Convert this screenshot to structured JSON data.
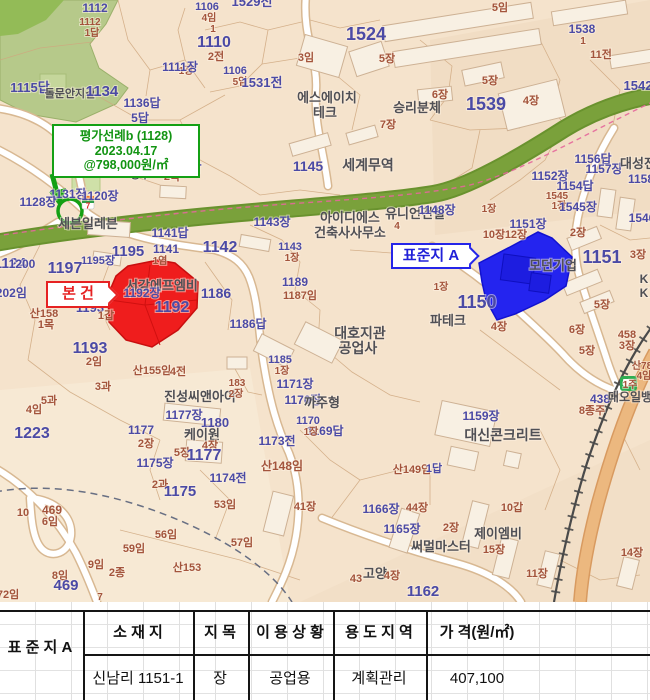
{
  "colors": {
    "parcel_text": "#4b4aa5",
    "suffix_text": "#a3543c",
    "poi_text": "#4f4f55",
    "note_green": "#14a014",
    "subject_red": "#e62222",
    "standard_blue": "#2525e8",
    "map_bg": "#f5e3cc",
    "forest": "#b6c98a",
    "greenway": "#7aa13b",
    "subject_parcel_fill": "#ef1d1d",
    "standard_parcel_fill": "#2424ef"
  },
  "map": {
    "green_note": {
      "line1": "평가선례b (1128)",
      "line2": "2023.04.17",
      "line3": "@798,000원/㎡"
    },
    "subject_label": "본 건",
    "standard_label": "표준지 A",
    "labels": [
      {
        "t": "1115답",
        "x": 30,
        "y": 92,
        "c": "p",
        "s": 13
      },
      {
        "t": "5답",
        "x": 140,
        "y": 122,
        "c": "p",
        "s": 12
      },
      {
        "t": "1116",
        "x": 162,
        "y": 163,
        "c": "p",
        "s": 19
      },
      {
        "t": "2목",
        "x": 172,
        "y": 180,
        "c": "m",
        "s": 11
      },
      {
        "t": "1124",
        "x": 10,
        "y": 268,
        "c": "p",
        "s": 15
      },
      {
        "t": "돌문안지길",
        "x": 70,
        "y": 97,
        "c": "g",
        "s": 11
      },
      {
        "t": "1134",
        "x": 102,
        "y": 96,
        "c": "p",
        "s": 15
      },
      {
        "t": "1112",
        "x": 95,
        "y": 12,
        "c": "p",
        "s": 12
      },
      {
        "t": "1112",
        "x": 90,
        "y": 25,
        "c": "m",
        "s": 10
      },
      {
        "t": "1답",
        "x": 92,
        "y": 36,
        "c": "m",
        "s": 10
      },
      {
        "t": "1136답",
        "x": 142,
        "y": 107,
        "c": "p",
        "s": 12
      },
      {
        "t": "1106",
        "x": 207,
        "y": 10,
        "c": "p",
        "s": 11
      },
      {
        "t": "4임",
        "x": 209,
        "y": 21,
        "c": "m",
        "s": 10
      },
      {
        "t": "1",
        "x": 213,
        "y": 32,
        "c": "m",
        "s": 10
      },
      {
        "t": "1529전",
        "x": 252,
        "y": 6,
        "c": "p",
        "s": 13
      },
      {
        "t": "1110",
        "x": 214,
        "y": 47,
        "c": "p",
        "s": 16
      },
      {
        "t": "2전",
        "x": 216,
        "y": 60,
        "c": "m",
        "s": 11
      },
      {
        "t": "1장",
        "x": 186,
        "y": 74,
        "c": "m",
        "s": 10
      },
      {
        "t": "1111장",
        "x": 180,
        "y": 71,
        "c": "p",
        "s": 12
      },
      {
        "t": "1106",
        "x": 235,
        "y": 74,
        "c": "p",
        "s": 11
      },
      {
        "t": "5임",
        "x": 240,
        "y": 85,
        "c": "m",
        "s": 10
      },
      {
        "t": "1531전",
        "x": 262,
        "y": 87,
        "c": "p",
        "s": 13
      },
      {
        "t": "3임",
        "x": 306,
        "y": 61,
        "c": "m",
        "s": 11
      },
      {
        "t": "1524",
        "x": 366,
        "y": 40,
        "c": "p",
        "s": 18
      },
      {
        "t": "5장",
        "x": 387,
        "y": 62,
        "c": "m",
        "s": 11
      },
      {
        "t": "에스에이치",
        "x": 327,
        "y": 102,
        "c": "g",
        "s": 13
      },
      {
        "t": "테크",
        "x": 325,
        "y": 117,
        "c": "g",
        "s": 13
      },
      {
        "t": "승리분체",
        "x": 417,
        "y": 112,
        "c": "g",
        "s": 13
      },
      {
        "t": "7장",
        "x": 388,
        "y": 128,
        "c": "m",
        "s": 11
      },
      {
        "t": "5임",
        "x": 500,
        "y": 11,
        "c": "m",
        "s": 11
      },
      {
        "t": "1538",
        "x": 582,
        "y": 33,
        "c": "p",
        "s": 12
      },
      {
        "t": "1",
        "x": 583,
        "y": 44,
        "c": "m",
        "s": 10
      },
      {
        "t": "11전",
        "x": 601,
        "y": 58,
        "c": "m",
        "s": 11
      },
      {
        "t": "5장",
        "x": 490,
        "y": 84,
        "c": "m",
        "s": 11
      },
      {
        "t": "6장",
        "x": 440,
        "y": 98,
        "c": "m",
        "s": 11
      },
      {
        "t": "1539",
        "x": 486,
        "y": 110,
        "c": "p",
        "s": 18
      },
      {
        "t": "4장",
        "x": 531,
        "y": 104,
        "c": "m",
        "s": 11
      },
      {
        "t": "1542",
        "x": 638,
        "y": 90,
        "c": "p",
        "s": 13
      },
      {
        "t": "1156답",
        "x": 593,
        "y": 163,
        "c": "p",
        "s": 12
      },
      {
        "t": "1157장",
        "x": 604,
        "y": 173,
        "c": "p",
        "s": 12
      },
      {
        "t": "대성전",
        "x": 638,
        "y": 168,
        "c": "g",
        "s": 13
      },
      {
        "t": "1152장",
        "x": 550,
        "y": 180,
        "c": "p",
        "s": 12
      },
      {
        "t": "1154답",
        "x": 575,
        "y": 190,
        "c": "p",
        "s": 12
      },
      {
        "t": "1545",
        "x": 557,
        "y": 199,
        "c": "m",
        "s": 10
      },
      {
        "t": "1장",
        "x": 559,
        "y": 209,
        "c": "m",
        "s": 10
      },
      {
        "t": "1545장",
        "x": 578,
        "y": 211,
        "c": "p",
        "s": 12
      },
      {
        "t": "1158",
        "x": 641,
        "y": 183,
        "c": "p",
        "s": 12
      },
      {
        "t": "1546",
        "x": 642,
        "y": 222,
        "c": "p",
        "s": 12
      },
      {
        "t": "1151장",
        "x": 528,
        "y": 228,
        "c": "p",
        "s": 12
      },
      {
        "t": "2장",
        "x": 578,
        "y": 236,
        "c": "m",
        "s": 11
      },
      {
        "t": "3장",
        "x": 638,
        "y": 258,
        "c": "m",
        "s": 11
      },
      {
        "t": "유니언건설",
        "x": 415,
        "y": 218,
        "c": "g",
        "s": 13
      },
      {
        "t": "1148장",
        "x": 437,
        "y": 214,
        "c": "p",
        "s": 12
      },
      {
        "t": "4",
        "x": 397,
        "y": 229,
        "c": "m",
        "s": 10
      },
      {
        "t": "1장",
        "x": 489,
        "y": 212,
        "c": "m",
        "s": 10
      },
      {
        "t": "10장",
        "x": 494,
        "y": 238,
        "c": "m",
        "s": 11
      },
      {
        "t": "12장",
        "x": 516,
        "y": 238,
        "c": "m",
        "s": 11
      },
      {
        "t": "1151",
        "x": 602,
        "y": 263,
        "c": "p",
        "s": 18
      },
      {
        "t": "모던기업",
        "x": 553,
        "y": 270,
        "c": "g",
        "s": 13
      },
      {
        "t": "K",
        "x": 644,
        "y": 283,
        "c": "g",
        "s": 12
      },
      {
        "t": "K",
        "x": 644,
        "y": 297,
        "c": "g",
        "s": 12
      },
      {
        "t": "1150",
        "x": 477,
        "y": 308,
        "c": "p",
        "s": 18
      },
      {
        "t": "파테크",
        "x": 448,
        "y": 325,
        "c": "g",
        "s": 13
      },
      {
        "t": "4장",
        "x": 499,
        "y": 330,
        "c": "m",
        "s": 11
      },
      {
        "t": "1장",
        "x": 441,
        "y": 290,
        "c": "m",
        "s": 10
      },
      {
        "t": "5장",
        "x": 602,
        "y": 308,
        "c": "m",
        "s": 11
      },
      {
        "t": "6장",
        "x": 577,
        "y": 333,
        "c": "m",
        "s": 11
      },
      {
        "t": "5장",
        "x": 587,
        "y": 354,
        "c": "m",
        "s": 11
      },
      {
        "t": "458",
        "x": 627,
        "y": 338,
        "c": "m",
        "s": 11
      },
      {
        "t": "3장",
        "x": 627,
        "y": 349,
        "c": "m",
        "s": 11
      },
      {
        "t": "산78",
        "x": 642,
        "y": 369,
        "c": "m",
        "s": 10
      },
      {
        "t": "4임",
        "x": 644,
        "y": 379,
        "c": "m",
        "s": 10
      },
      {
        "t": "1주",
        "x": 630,
        "y": 388,
        "c": "m",
        "s": 10
      },
      {
        "t": "1145",
        "x": 308,
        "y": 171,
        "c": "p",
        "s": 14
      },
      {
        "t": "세계무역",
        "x": 368,
        "y": 170,
        "c": "g",
        "s": 14
      },
      {
        "t": "아이디에스",
        "x": 350,
        "y": 222,
        "c": "g",
        "s": 13
      },
      {
        "t": "건축사사무소",
        "x": 350,
        "y": 237,
        "c": "g",
        "s": 13
      },
      {
        "t": "1143장",
        "x": 272,
        "y": 226,
        "c": "p",
        "s": 12
      },
      {
        "t": "1142",
        "x": 220,
        "y": 252,
        "c": "p",
        "s": 16
      },
      {
        "t": "1143",
        "x": 290,
        "y": 250,
        "c": "p",
        "s": 11
      },
      {
        "t": "1장",
        "x": 292,
        "y": 261,
        "c": "m",
        "s": 10
      },
      {
        "t": "1140답",
        "x": 183,
        "y": 172,
        "c": "p",
        "s": 12
      },
      {
        "t": "싱루",
        "x": 140,
        "y": 178,
        "c": "g",
        "s": 11
      },
      {
        "t": "1131장",
        "x": 68,
        "y": 198,
        "c": "p",
        "s": 12
      },
      {
        "t": "1120장",
        "x": 100,
        "y": 200,
        "c": "p",
        "s": 12
      },
      {
        "t": "1128장",
        "x": 38,
        "y": 206,
        "c": "p",
        "s": 12
      },
      {
        "t": "세븐일레븐",
        "x": 88,
        "y": 228,
        "c": "g",
        "s": 13
      },
      {
        "t": "1141답",
        "x": 170,
        "y": 237,
        "c": "p",
        "s": 12
      },
      {
        "t": "1141",
        "x": 166,
        "y": 253,
        "c": "p",
        "s": 12
      },
      {
        "t": "1염",
        "x": 160,
        "y": 264,
        "c": "m",
        "s": 10
      },
      {
        "t": "1195",
        "x": 128,
        "y": 256,
        "c": "p",
        "s": 15
      },
      {
        "t": "1195장",
        "x": 98,
        "y": 264,
        "c": "p",
        "s": 11
      },
      {
        "t": "1197",
        "x": 65,
        "y": 273,
        "c": "p",
        "s": 16
      },
      {
        "t": "1200",
        "x": 22,
        "y": 268,
        "c": "p",
        "s": 12
      },
      {
        "t": "1202임",
        "x": 8,
        "y": 297,
        "c": "p",
        "s": 12
      },
      {
        "t": "산158",
        "x": 44,
        "y": 317,
        "c": "m",
        "s": 11
      },
      {
        "t": "1목",
        "x": 46,
        "y": 328,
        "c": "m",
        "s": 11
      },
      {
        "t": "서강에프엠비",
        "x": 162,
        "y": 290,
        "c": "g",
        "s": 13
      },
      {
        "t": "1192장",
        "x": 142,
        "y": 297,
        "c": "p",
        "s": 12
      },
      {
        "t": "1192",
        "x": 172,
        "y": 312,
        "c": "p",
        "s": 16
      },
      {
        "t": "1186",
        "x": 216,
        "y": 298,
        "c": "p",
        "s": 14
      },
      {
        "t": "1189",
        "x": 295,
        "y": 286,
        "c": "p",
        "s": 12
      },
      {
        "t": "1187임",
        "x": 300,
        "y": 299,
        "c": "m",
        "s": 11
      },
      {
        "t": "1186답",
        "x": 248,
        "y": 328,
        "c": "p",
        "s": 12
      },
      {
        "t": "1193",
        "x": 90,
        "y": 312,
        "c": "p",
        "s": 13
      },
      {
        "t": "1갑",
        "x": 106,
        "y": 319,
        "c": "m",
        "s": 11
      },
      {
        "t": "1193",
        "x": 90,
        "y": 353,
        "c": "p",
        "s": 16
      },
      {
        "t": "2임",
        "x": 94,
        "y": 365,
        "c": "m",
        "s": 11
      },
      {
        "t": "1223",
        "x": 32,
        "y": 438,
        "c": "p",
        "s": 16
      },
      {
        "t": "산155임",
        "x": 152,
        "y": 374,
        "c": "m",
        "s": 11
      },
      {
        "t": "4전",
        "x": 178,
        "y": 375,
        "c": "m",
        "s": 11
      },
      {
        "t": "3과",
        "x": 103,
        "y": 390,
        "c": "m",
        "s": 11
      },
      {
        "t": "5과",
        "x": 49,
        "y": 404,
        "c": "m",
        "s": 11
      },
      {
        "t": "4임",
        "x": 34,
        "y": 413,
        "c": "m",
        "s": 11
      },
      {
        "t": "진성씨앤아이",
        "x": 200,
        "y": 401,
        "c": "g",
        "s": 13
      },
      {
        "t": "1177장",
        "x": 184,
        "y": 419,
        "c": "p",
        "s": 12
      },
      {
        "t": "1180",
        "x": 215,
        "y": 427,
        "c": "p",
        "s": 13
      },
      {
        "t": "케이원",
        "x": 202,
        "y": 439,
        "c": "g",
        "s": 13
      },
      {
        "t": "4장",
        "x": 210,
        "y": 449,
        "c": "m",
        "s": 11
      },
      {
        "t": "1177",
        "x": 141,
        "y": 434,
        "c": "p",
        "s": 12
      },
      {
        "t": "2장",
        "x": 146,
        "y": 447,
        "c": "m",
        "s": 11
      },
      {
        "t": "5장",
        "x": 182,
        "y": 456,
        "c": "m",
        "s": 11
      },
      {
        "t": "1177",
        "x": 204,
        "y": 460,
        "c": "p",
        "s": 16
      },
      {
        "t": "1175장",
        "x": 155,
        "y": 467,
        "c": "p",
        "s": 12
      },
      {
        "t": "2과",
        "x": 160,
        "y": 488,
        "c": "m",
        "s": 11
      },
      {
        "t": "1175",
        "x": 180,
        "y": 496,
        "c": "p",
        "s": 15
      },
      {
        "t": "1174전",
        "x": 228,
        "y": 482,
        "c": "p",
        "s": 12
      },
      {
        "t": "53임",
        "x": 225,
        "y": 508,
        "c": "m",
        "s": 11
      },
      {
        "t": "산148임",
        "x": 282,
        "y": 470,
        "c": "m",
        "s": 12
      },
      {
        "t": "1173전",
        "x": 277,
        "y": 445,
        "c": "p",
        "s": 12
      },
      {
        "t": "1169답",
        "x": 325,
        "y": 435,
        "c": "p",
        "s": 12
      },
      {
        "t": "1170",
        "x": 308,
        "y": 424,
        "c": "p",
        "s": 11
      },
      {
        "t": "1장",
        "x": 311,
        "y": 435,
        "c": "m",
        "s": 10
      },
      {
        "t": "1171장",
        "x": 295,
        "y": 388,
        "c": "p",
        "s": 12
      },
      {
        "t": "1170장",
        "x": 303,
        "y": 404,
        "c": "p",
        "s": 12
      },
      {
        "t": "까주형",
        "x": 322,
        "y": 407,
        "c": "g",
        "s": 13
      },
      {
        "t": "1185",
        "x": 280,
        "y": 363,
        "c": "p",
        "s": 11
      },
      {
        "t": "1장",
        "x": 282,
        "y": 374,
        "c": "m",
        "s": 10
      },
      {
        "t": "183",
        "x": 237,
        "y": 386,
        "c": "m",
        "s": 10
      },
      {
        "t": "2장",
        "x": 236,
        "y": 397,
        "c": "m",
        "s": 10
      },
      {
        "t": "대호지관",
        "x": 360,
        "y": 338,
        "c": "g",
        "s": 14
      },
      {
        "t": "공업사",
        "x": 358,
        "y": 353,
        "c": "g",
        "s": 14
      },
      {
        "t": "41장",
        "x": 305,
        "y": 510,
        "c": "m",
        "s": 11
      },
      {
        "t": "56임",
        "x": 166,
        "y": 538,
        "c": "m",
        "s": 11
      },
      {
        "t": "57임",
        "x": 242,
        "y": 546,
        "c": "m",
        "s": 11
      },
      {
        "t": "59임",
        "x": 134,
        "y": 552,
        "c": "m",
        "s": 11
      },
      {
        "t": "10",
        "x": 23,
        "y": 516,
        "c": "m",
        "s": 11
      },
      {
        "t": "469",
        "x": 52,
        "y": 514,
        "c": "m",
        "s": 12
      },
      {
        "t": "6임",
        "x": 50,
        "y": 525,
        "c": "m",
        "s": 11
      },
      {
        "t": "8임",
        "x": 60,
        "y": 579,
        "c": "m",
        "s": 11
      },
      {
        "t": "469",
        "x": 66,
        "y": 590,
        "c": "p",
        "s": 15
      },
      {
        "t": "9임",
        "x": 96,
        "y": 568,
        "c": "m",
        "s": 11
      },
      {
        "t": "2종",
        "x": 117,
        "y": 576,
        "c": "m",
        "s": 11
      },
      {
        "t": "산153",
        "x": 187,
        "y": 571,
        "c": "m",
        "s": 11
      },
      {
        "t": "72임",
        "x": 8,
        "y": 598,
        "c": "m",
        "s": 11
      },
      {
        "t": "7",
        "x": 100,
        "y": 600,
        "c": "m",
        "s": 10
      },
      {
        "t": "1166장",
        "x": 381,
        "y": 513,
        "c": "p",
        "s": 12
      },
      {
        "t": "1165장",
        "x": 402,
        "y": 533,
        "c": "p",
        "s": 12
      },
      {
        "t": "44장",
        "x": 417,
        "y": 511,
        "c": "m",
        "s": 11
      },
      {
        "t": "2장",
        "x": 451,
        "y": 531,
        "c": "m",
        "s": 11
      },
      {
        "t": "10갑",
        "x": 512,
        "y": 511,
        "c": "m",
        "s": 11
      },
      {
        "t": "써멀마스터",
        "x": 441,
        "y": 551,
        "c": "g",
        "s": 13
      },
      {
        "t": "제이엠비",
        "x": 498,
        "y": 538,
        "c": "g",
        "s": 13
      },
      {
        "t": "15장",
        "x": 494,
        "y": 553,
        "c": "m",
        "s": 11
      },
      {
        "t": "11장",
        "x": 537,
        "y": 577,
        "c": "m",
        "s": 11
      },
      {
        "t": "고양",
        "x": 375,
        "y": 578,
        "c": "g",
        "s": 13
      },
      {
        "t": "4장",
        "x": 392,
        "y": 579,
        "c": "m",
        "s": 11
      },
      {
        "t": "43",
        "x": 356,
        "y": 582,
        "c": "m",
        "s": 11
      },
      {
        "t": "1162",
        "x": 423,
        "y": 596,
        "c": "p",
        "s": 15
      },
      {
        "t": "14장",
        "x": 632,
        "y": 556,
        "c": "m",
        "s": 11
      },
      {
        "t": "1159장",
        "x": 481,
        "y": 420,
        "c": "p",
        "s": 12
      },
      {
        "t": "대신콘크리트",
        "x": 503,
        "y": 440,
        "c": "g",
        "s": 14
      },
      {
        "t": "438",
        "x": 600,
        "y": 403,
        "c": "p",
        "s": 12
      },
      {
        "t": "8종주",
        "x": 592,
        "y": 414,
        "c": "m",
        "s": 11
      },
      {
        "t": "대오일뱅",
        "x": 630,
        "y": 401,
        "c": "g",
        "s": 12
      },
      {
        "t": "산149임",
        "x": 412,
        "y": 473,
        "c": "m",
        "s": 11
      },
      {
        "t": "1답",
        "x": 434,
        "y": 472,
        "c": "p",
        "s": 11
      }
    ]
  },
  "table": {
    "row_header": "표 준 지 A",
    "columns": [
      "소 재 지",
      "지 목",
      "이 용 상 황",
      "용 도 지 역",
      "가 격(원/㎡)"
    ],
    "row": [
      "신남리 1151-1",
      "장",
      "공업용",
      "계획관리",
      "407,100"
    ]
  }
}
